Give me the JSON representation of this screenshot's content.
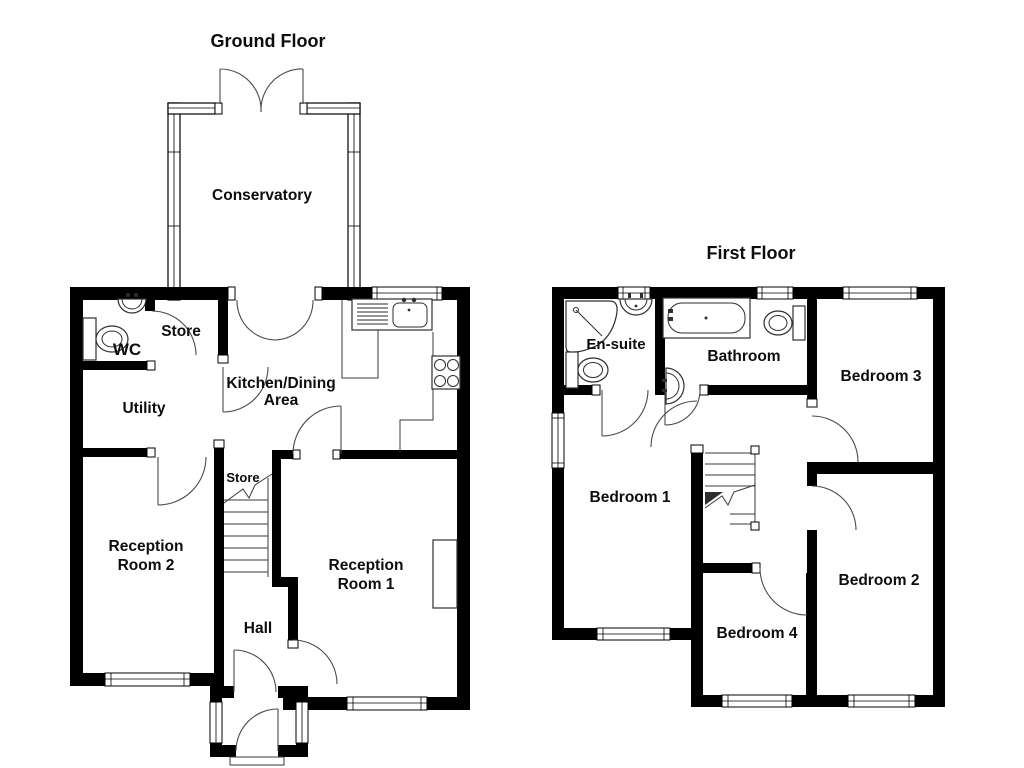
{
  "document": {
    "type": "floor-plan-drawing",
    "background": "#ffffff"
  },
  "colors": {
    "wall": "#000000",
    "door_line": "#4a4a4a",
    "fixture_line": "#2e2e2e",
    "text": "#0d0d0d"
  },
  "ground_floor": {
    "title": "Ground Floor",
    "rooms": {
      "conservatory": "Conservatory",
      "store_top": "Store",
      "wc": "WC",
      "utility": "Utility",
      "kitchen_line1": "Kitchen/Dining",
      "kitchen_line2": "Area",
      "store_stairs": "Store",
      "reception2_line1": "Reception",
      "reception2_line2": "Room 2",
      "reception1_line1": "Reception",
      "reception1_line2": "Room 1",
      "hall": "Hall"
    },
    "fixtures": [
      "toilet",
      "wash-basin",
      "kitchen-sink",
      "hob",
      "worktop",
      "stairs",
      "fireplace",
      "conservatory-double-doors",
      "kitchen-double-doors",
      "front-door"
    ]
  },
  "first_floor": {
    "title": "First Floor",
    "rooms": {
      "ensuite": "En-suite",
      "bathroom": "Bathroom",
      "bedroom1": "Bedroom 1",
      "bedroom2": "Bedroom 2",
      "bedroom3": "Bedroom 3",
      "bedroom4": "Bedroom 4"
    },
    "fixtures": [
      "shower",
      "wash-basin",
      "toilet",
      "bath",
      "stairs"
    ]
  }
}
